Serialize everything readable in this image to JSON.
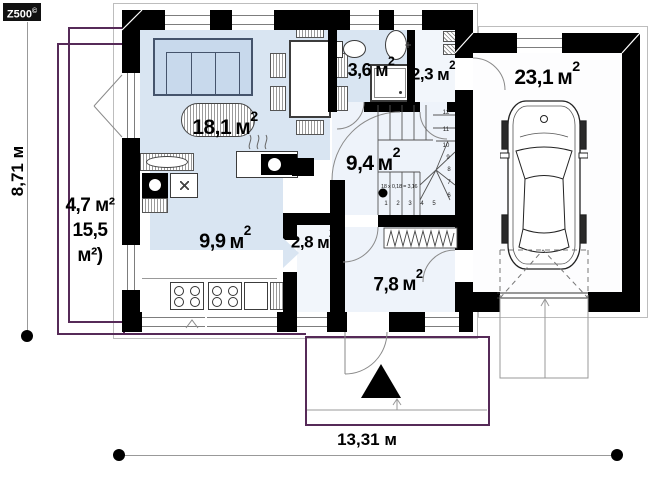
{
  "logo": {
    "text": "Z500",
    "sup": "©"
  },
  "dimensions": {
    "height_label": "8,71 м",
    "width_label": "13,31 м"
  },
  "rooms": [
    {
      "name": "living-room",
      "value": "18,1",
      "unit": "м",
      "sup": "2"
    },
    {
      "name": "kitchen",
      "value": "9,9",
      "unit": "м",
      "sup": "2"
    },
    {
      "name": "bathroom",
      "value": "3,6",
      "unit": "м",
      "sup": "2"
    },
    {
      "name": "closet",
      "value": "2,3",
      "unit": "м",
      "sup": "2"
    },
    {
      "name": "garage",
      "value": "23,1",
      "unit": "м",
      "sup": "2"
    },
    {
      "name": "hall",
      "value": "9,4",
      "unit": "м",
      "sup": "2"
    },
    {
      "name": "pantry",
      "value": "2,8",
      "unit": "м",
      "sup": "2"
    },
    {
      "name": "vestibule",
      "value": "7,8",
      "unit": "м",
      "sup": "2"
    }
  ],
  "terrace": {
    "lines": [
      "4,7 м²",
      "15,5",
      "м²)"
    ]
  },
  "stairs": {
    "note": "18 x 0,18 = 3,16",
    "steps": [
      "1",
      "2",
      "3",
      "4",
      "5",
      "6",
      "7",
      "8",
      "9",
      "10",
      "11",
      "12"
    ]
  }
}
